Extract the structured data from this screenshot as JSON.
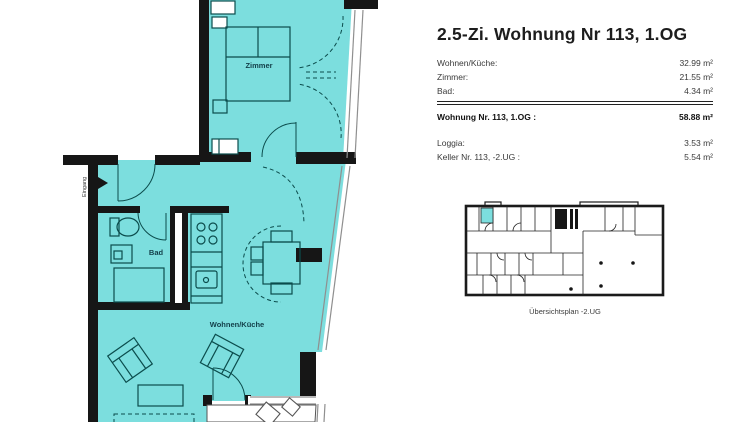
{
  "header": {
    "title": "2.5-Zi. Wohnung Nr 113, 1.OG"
  },
  "area_table": {
    "rows": [
      {
        "label": "Wohnen/Küche:",
        "value": "32.99 m²"
      },
      {
        "label": "Zimmer:",
        "value": "21.55 m²"
      },
      {
        "label": "Bad:",
        "value": "4.34 m²"
      }
    ],
    "total_row": {
      "label": "Wohnung Nr. 113, 1.OG :",
      "value": "58.88 m²"
    },
    "extra_rows": [
      {
        "label": "Loggia:",
        "value": "3.53 m²"
      },
      {
        "label": "Keller Nr. 113, -2.UG :",
        "value": "5.54 m²"
      }
    ]
  },
  "floorplan": {
    "labels": {
      "bedroom": "Zimmer",
      "bathroom": "Bad",
      "living_kitchen": "Wohnen/Küche",
      "entrance": "Eingang"
    },
    "colors": {
      "room_fill": "#7CDEDE",
      "wall": "#161616",
      "furniture_line": "#0B4C4C"
    }
  },
  "overview": {
    "caption": "Übersichtsplan -2.UG",
    "highlight_color": "#7CDEDE"
  }
}
